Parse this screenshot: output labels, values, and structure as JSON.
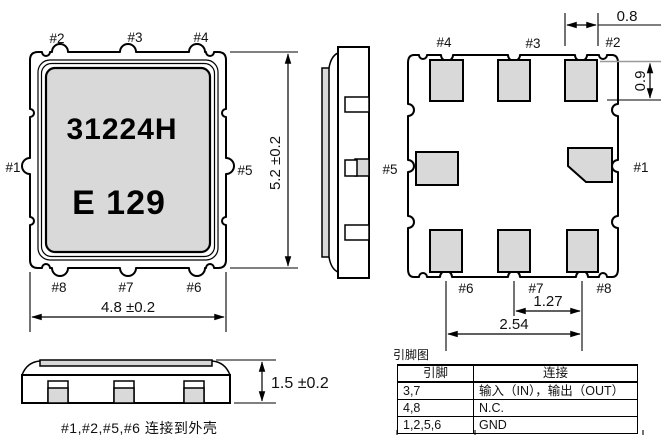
{
  "front_view": {
    "marking_line1": "31224H",
    "marking_line2": "E 129",
    "labels": {
      "p1": "#1",
      "p2": "#2",
      "p3": "#3",
      "p4": "#4",
      "p5": "#5",
      "p6": "#6",
      "p7": "#7",
      "p8": "#8"
    },
    "dim_height": "5.2 ±0.2",
    "dim_width": "4.8 ±0.2"
  },
  "side_view": {
    "label_p5": "#5"
  },
  "bottom_view": {
    "labels": {
      "p1": "#1",
      "p2": "#2",
      "p3": "#3",
      "p4": "#4",
      "p6": "#6",
      "p7": "#7",
      "p8": "#8"
    },
    "dim_pad_width": "0.8",
    "dim_pad_height": "0.9",
    "dim_pitch_1": "1.27",
    "dim_pitch_2": "2.54"
  },
  "profile_view": {
    "dim_thickness": "1.5 ±0.2"
  },
  "note_case": "#1,#2,#5,#6  连接到外壳",
  "pin_table": {
    "title": "引脚图",
    "col_pin": "引脚",
    "col_conn": "连接",
    "rows": [
      {
        "pin": "3,7",
        "conn": "输入（IN），输出（OUT）"
      },
      {
        "pin": "4,8",
        "conn": "N.C."
      },
      {
        "pin": "1,2,5,6",
        "conn": "GND"
      }
    ]
  },
  "colors": {
    "pad_fill": "#d9d9d9",
    "line": "#000000",
    "dim_gray_line": "#9a9a9a"
  }
}
